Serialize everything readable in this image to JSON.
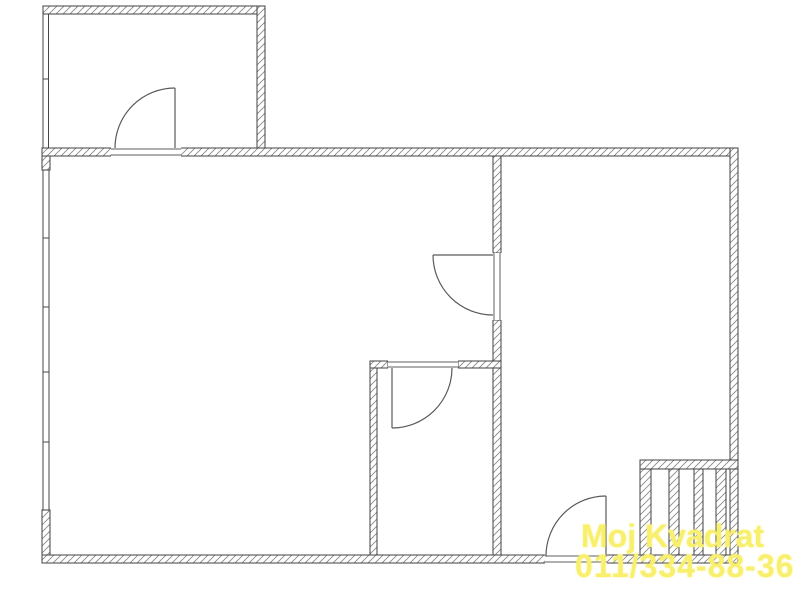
{
  "document": {
    "type": "architectural floor plan drawing",
    "background_color": "#ffffff",
    "line_color": "#404040",
    "hatch_color": "#8a8a8a"
  },
  "watermark": {
    "line1": "Moj Kvadrat",
    "line2": "011/334-88-36",
    "color": "#f8ef6d"
  },
  "floor_plan": {
    "canvas": {
      "width": 795,
      "height": 600
    },
    "rooms": [
      {
        "id": "top-left-room",
        "bounds_px": [
          43,
          6,
          265,
          156
        ]
      },
      {
        "id": "main-room",
        "bounds_px": [
          42,
          148,
          501,
          563
        ]
      },
      {
        "id": "inner-room",
        "bounds_px": [
          370,
          361,
          501,
          563
        ]
      },
      {
        "id": "right-room",
        "bounds_px": [
          493,
          148,
          738,
          563
        ]
      }
    ],
    "doors": [
      {
        "id": "door-top-left-room",
        "in_wall": "horizontal y=148-156",
        "opening_x": [
          111,
          181
        ],
        "hinge": [
          175,
          148
        ],
        "swing": "up into top-left room"
      },
      {
        "id": "door-divider-right-room",
        "in_wall": "vertical x=493-501",
        "opening_y": [
          253,
          320
        ],
        "hinge": [
          493,
          255
        ],
        "swing": "down-left into main room"
      },
      {
        "id": "door-inner-room",
        "in_wall": "horizontal y=361-368",
        "opening_x": [
          388,
          458
        ],
        "hinge": [
          392,
          368
        ],
        "swing": "down into inner room"
      },
      {
        "id": "door-bottom-exterior",
        "in_wall": "horizontal y=555-563",
        "opening_x": [
          545,
          607
        ],
        "hinge": [
          606,
          556
        ],
        "swing": "up-left into right room"
      }
    ],
    "windows": [
      {
        "id": "window-band-top-left-room",
        "edge": "left",
        "x": [
          42,
          49
        ],
        "span_y": [
          14,
          148
        ],
        "mullions_y": [
          79
        ]
      },
      {
        "id": "window-band-main-room",
        "edge": "left",
        "x": [
          42,
          50
        ],
        "span_y": [
          170,
          510
        ],
        "mullions_y": [
          238,
          307,
          372,
          442
        ]
      }
    ],
    "ventilation_shaft": {
      "id": "ventilation-shaft-block",
      "bounds_px": [
        640,
        460,
        738,
        563
      ],
      "flue_slots": 4
    }
  }
}
